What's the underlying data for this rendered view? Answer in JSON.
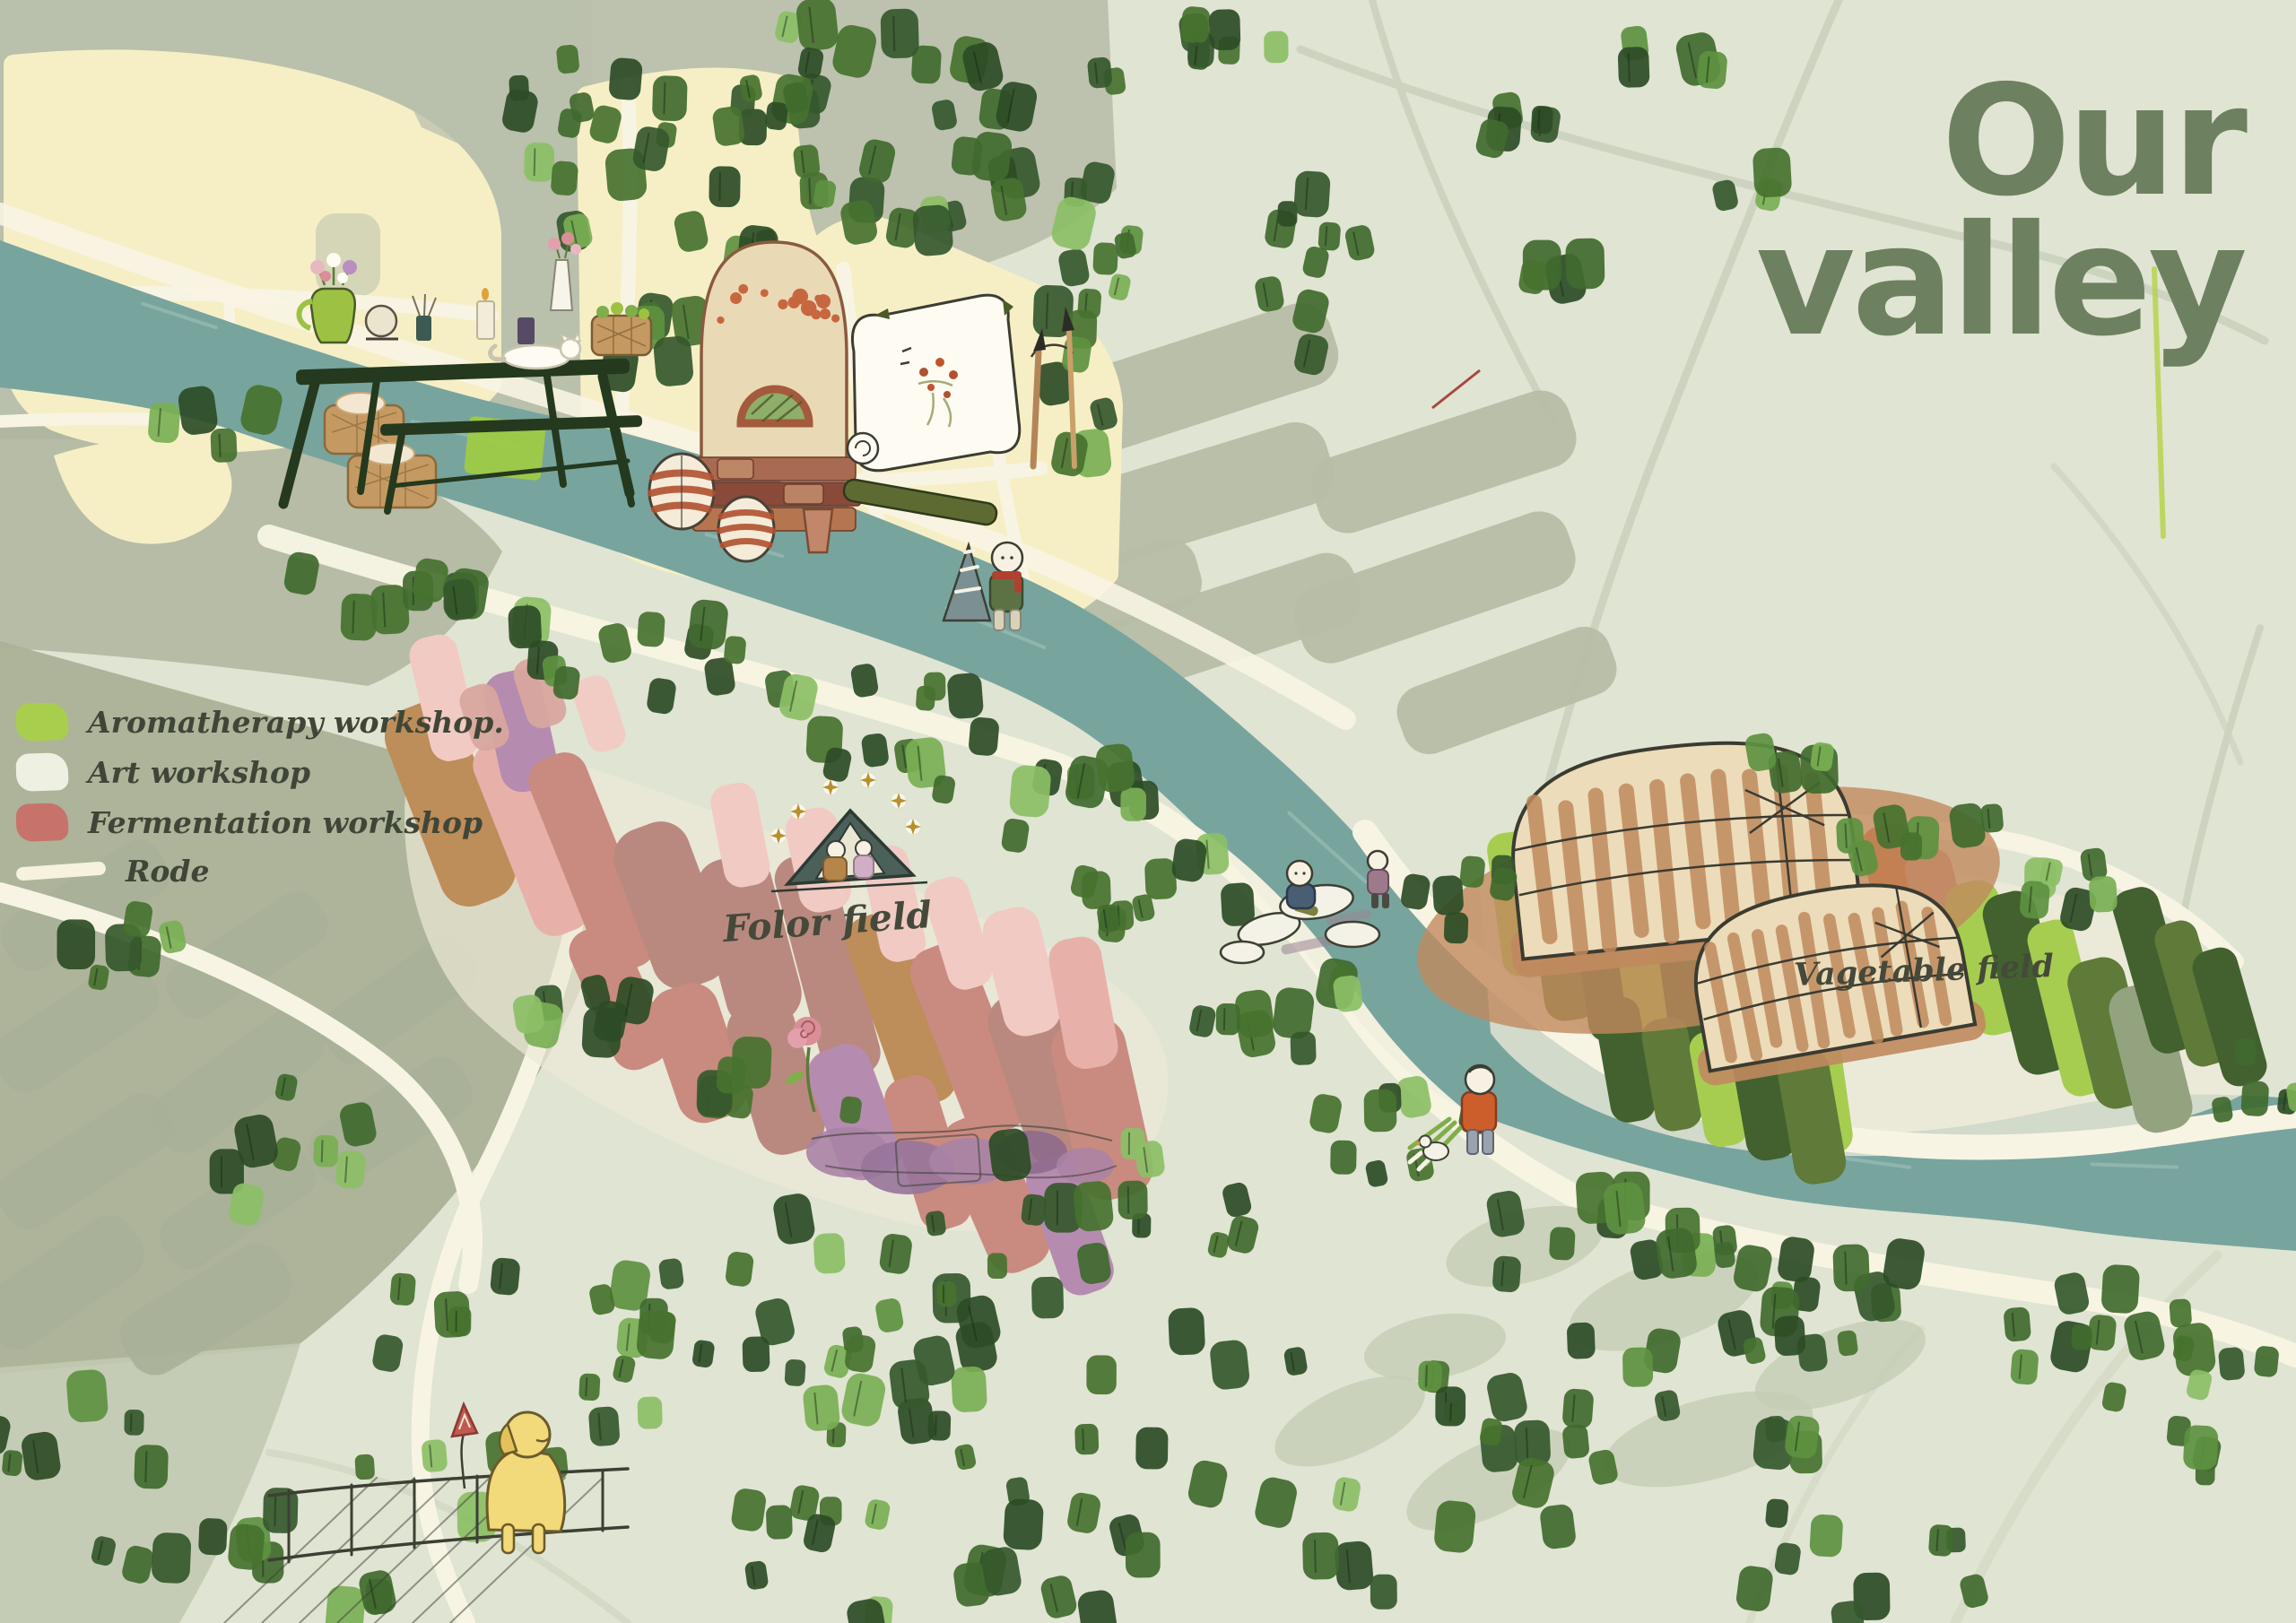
{
  "title": {
    "line1": "Our",
    "line2": "valley",
    "color": "#6d8160"
  },
  "legend": {
    "text_color": "#3f4637",
    "items": [
      {
        "id": "aromatherapy",
        "label": "Aromatherapy workshop.",
        "swatch": "#a9ce4d",
        "shape": "patch"
      },
      {
        "id": "art",
        "label": "Art workshop",
        "swatch": "#eef0e2",
        "shape": "patch"
      },
      {
        "id": "fermentation",
        "label": "Fermentation workshop",
        "swatch": "#c7736b",
        "shape": "patch"
      },
      {
        "id": "rode",
        "label": "Rode",
        "swatch": "#f6f2de",
        "shape": "line"
      }
    ]
  },
  "map_labels": {
    "flower_field": "Folor field",
    "vegetable_field": "Vagetable field",
    "label_color": "#45493a"
  },
  "palette": {
    "background": "#e0e4d2",
    "river": "#78a49e",
    "river_highlight": "#9fc2ba",
    "road": "#f8f4e3",
    "village_field": "#f6efc5",
    "terrace": "#b6bda5",
    "paddy": "#a9b098",
    "gray_wash": "#b9c0ab",
    "tree_darks": [
      "#2c4c26",
      "#35582c",
      "#406a2e",
      "#47722f"
    ],
    "tree_lights": [
      "#5d9140",
      "#79af54",
      "#8cbf66"
    ],
    "flower_field_colors": [
      "#c98a80",
      "#e7b1a9",
      "#f1cac3",
      "#b9897f",
      "#bd8d5a",
      "#b58cb0",
      "#d8a79e"
    ],
    "vegetable_field_colors": {
      "lime": "#a6cd50",
      "olive": "#5f7a39",
      "dark": "#42612f",
      "sage": "#93a37f",
      "orange": "#cc5e2c",
      "pink": "#cb8a80"
    },
    "greenhouse_body": "#ecdcba",
    "greenhouse_stripe": "#c08a5e",
    "sketch_ink": "#3c4034"
  }
}
